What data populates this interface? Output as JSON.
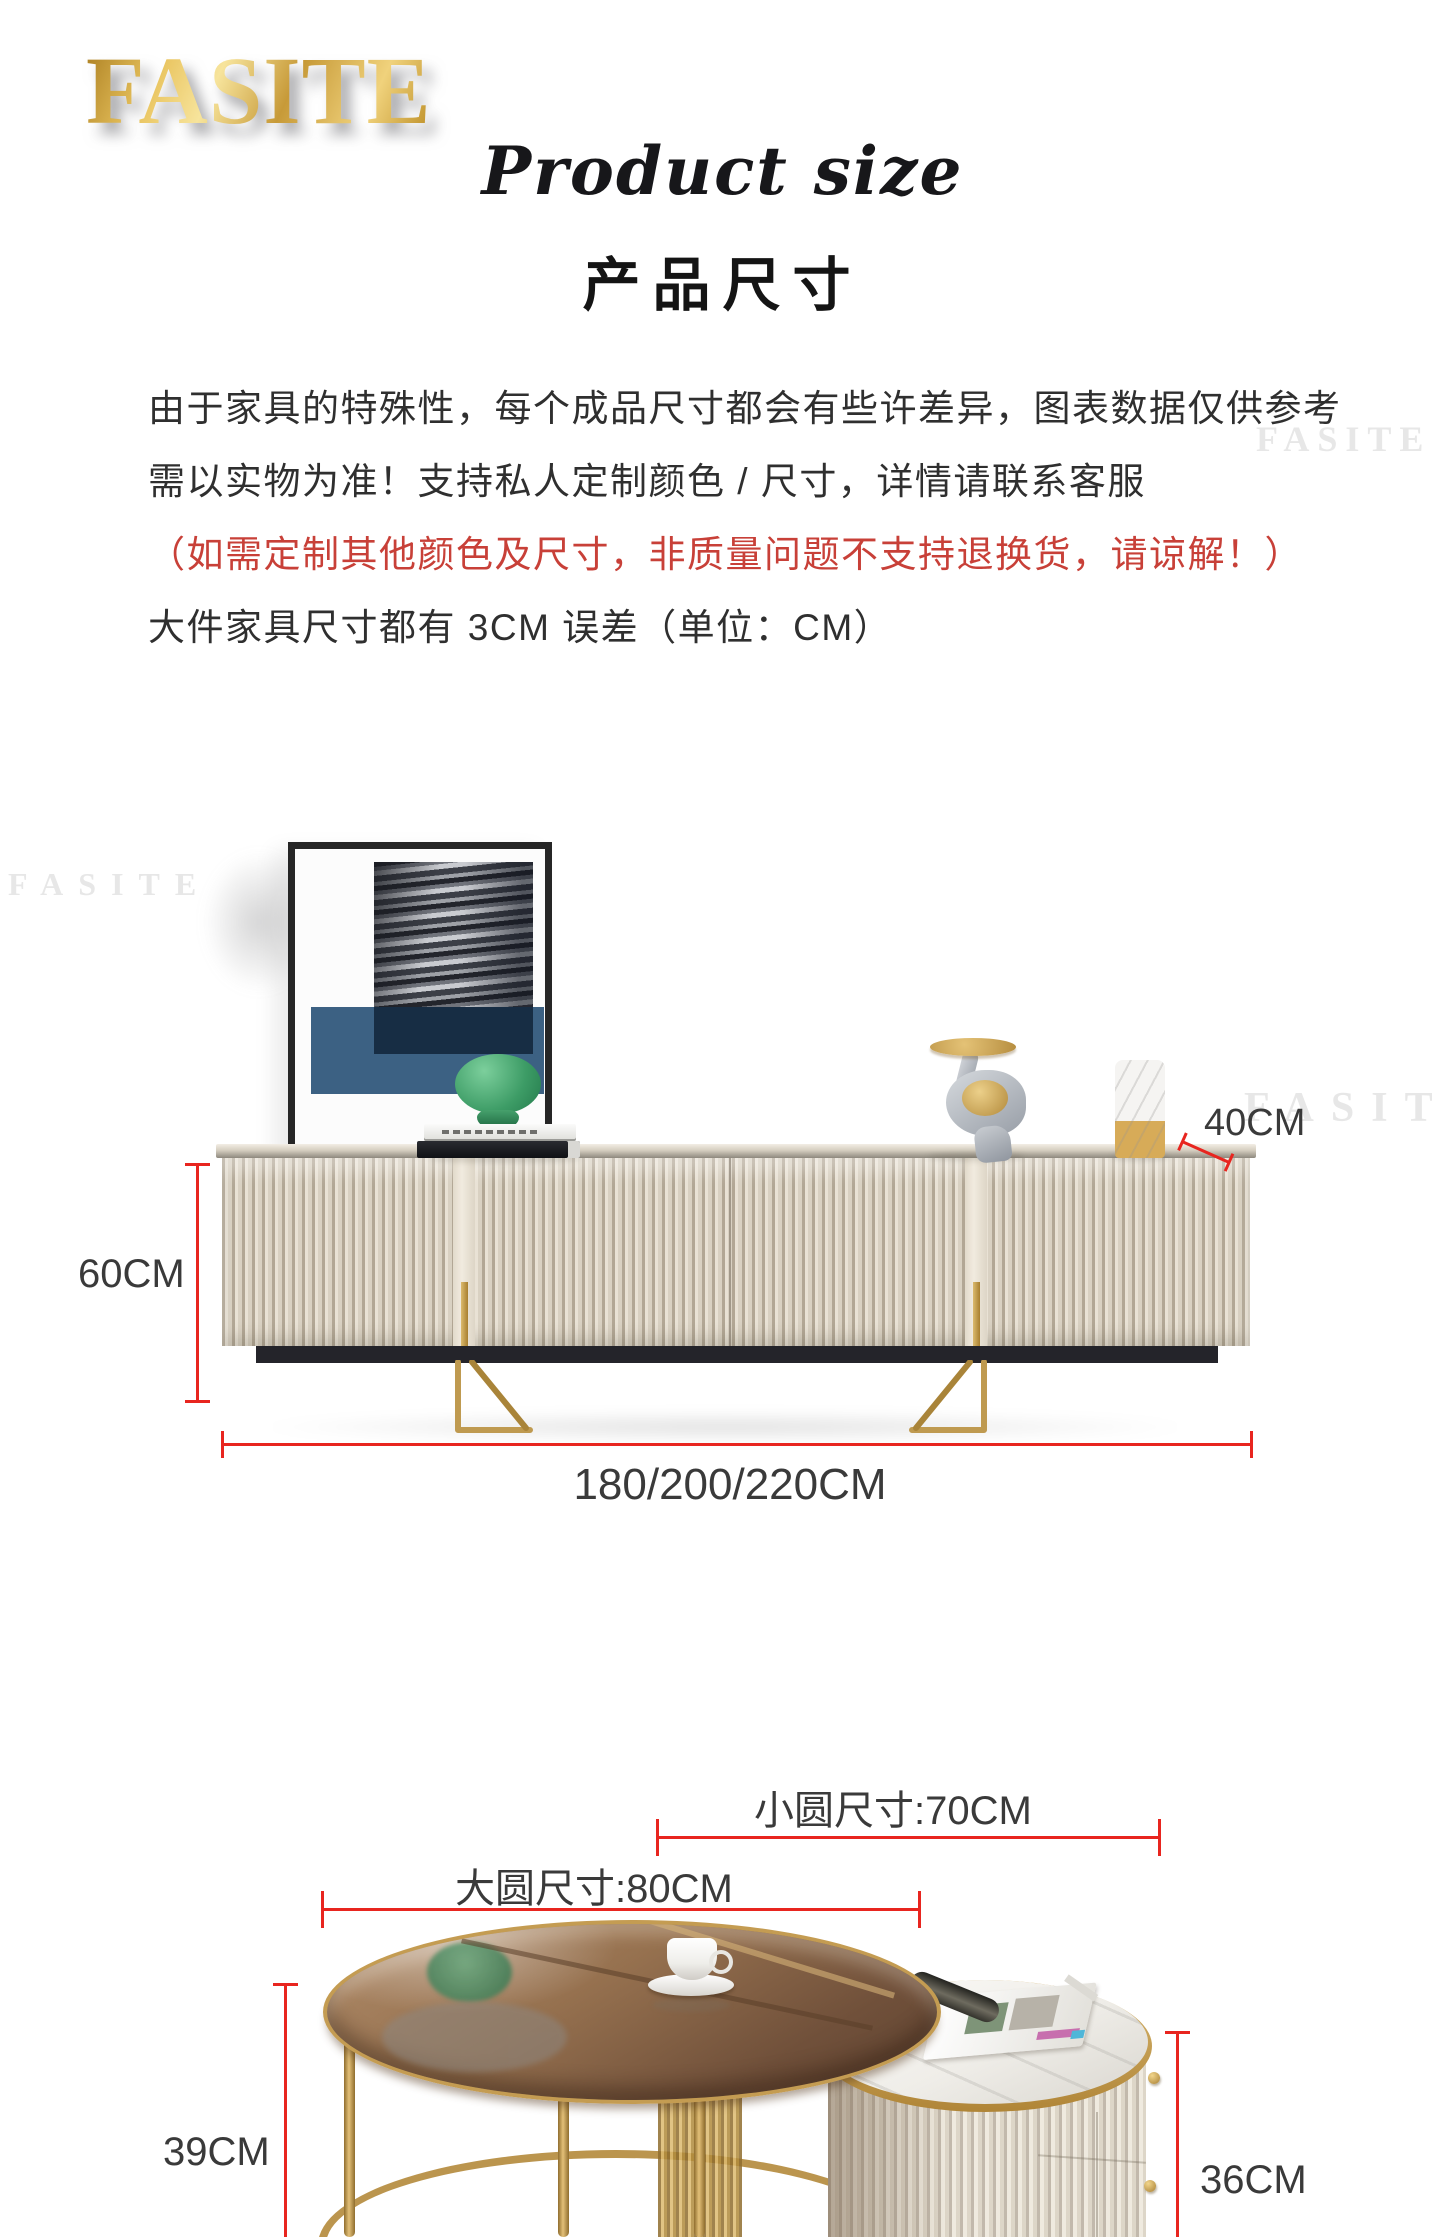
{
  "brand": {
    "logo_text": "FASITE",
    "watermark_text": "FASITE"
  },
  "header": {
    "title_script": "Product size",
    "title_cn": "产品尺寸"
  },
  "notice": {
    "line1": "由于家具的特殊性，每个成品尺寸都会有些许差异，图表数据仅供参考",
    "line2": "需以实物为准！支持私人定制颜色 / 尺寸，详情请联系客服",
    "line3": "（如需定制其他颜色及尺寸，非质量问题不支持退换货，请谅解！）",
    "line4": "大件家具尺寸都有 3CM 误差（单位：CM）"
  },
  "tv_stand_diagram": {
    "height_label": "60CM",
    "depth_label": "40CM",
    "width_label": "180/200/220CM"
  },
  "coffee_table_diagram": {
    "small_round_label": "小圆尺寸:70CM",
    "large_round_label": "大圆尺寸:80CM",
    "large_table_height_label": "39CM",
    "small_table_height_label": "36CM"
  },
  "colors": {
    "dimension_red": "#e8251f",
    "notice_red": "#c84038",
    "logo_gold": "#d5a945",
    "metal_gold": "#bb954e",
    "cabinet_beige": "#e2dbce",
    "plinth_black": "#24242a",
    "art_blue": "#3c6183",
    "lamp_green": "#3d9c66",
    "text_dark": "#2f2f2f",
    "watermark_gray": "#e7e7e7"
  }
}
